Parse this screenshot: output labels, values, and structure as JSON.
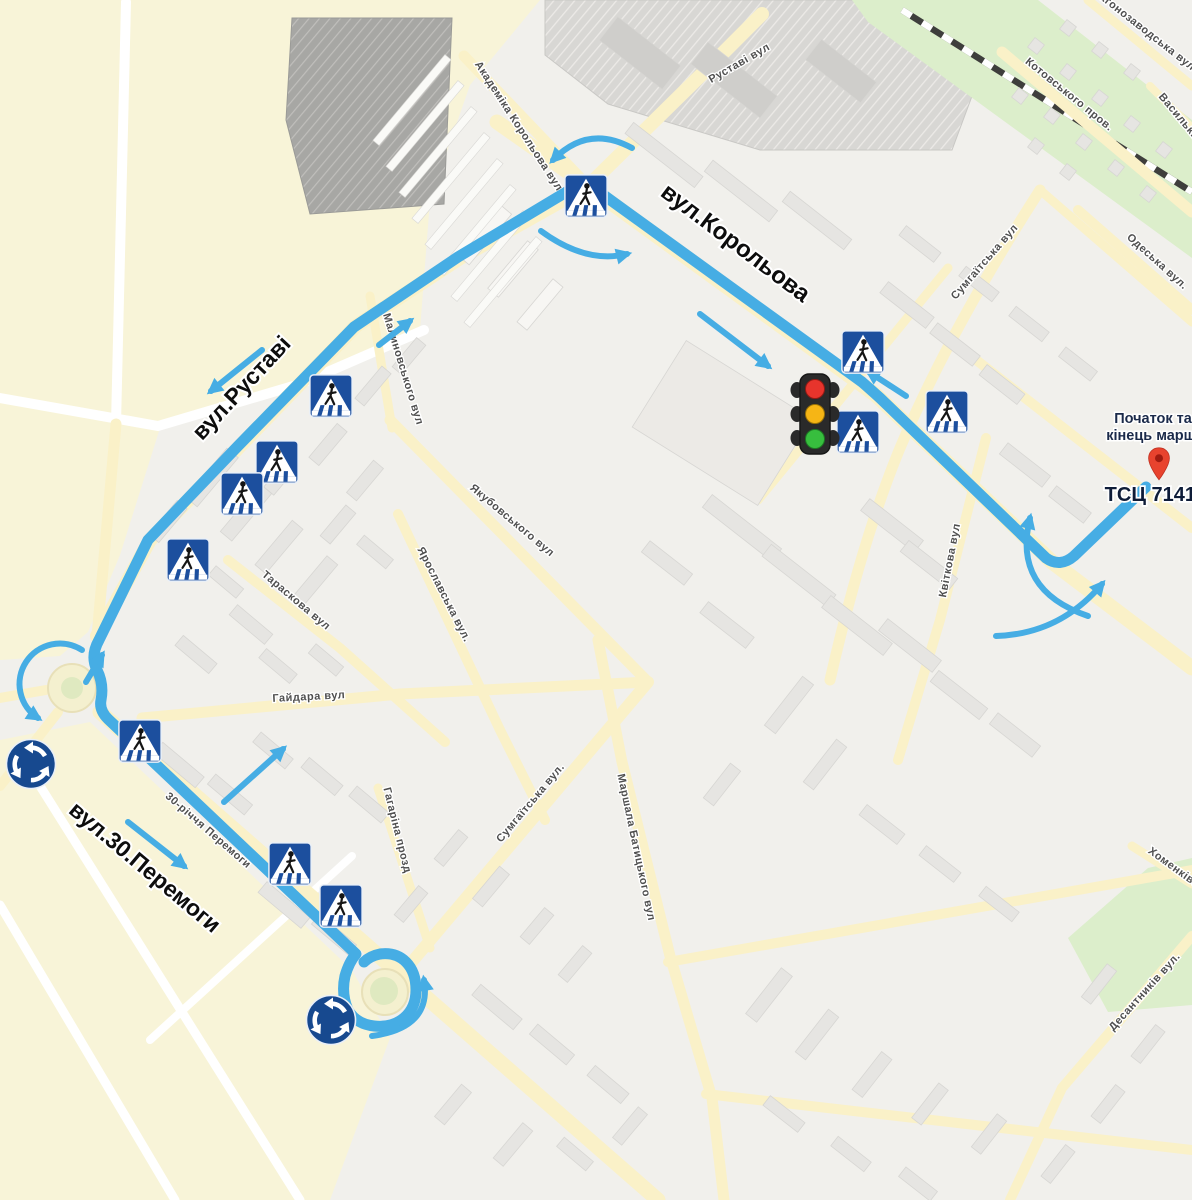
{
  "route_labels": [
    {
      "name": "route-street-label-korolova",
      "text": "вул.Корольова",
      "x": 731,
      "y": 249,
      "rot": 37,
      "size": 24
    },
    {
      "name": "route-street-label-rustavi",
      "text": "вул.Руставі",
      "x": 247,
      "y": 393,
      "rot": -47,
      "size": 23
    },
    {
      "name": "route-street-label-peremohy",
      "text": "вул.30.Перемоги",
      "x": 140,
      "y": 873,
      "rot": 40,
      "size": 23
    }
  ],
  "street_labels": [
    {
      "text": "Руставі вул",
      "x": 741,
      "y": 66,
      "rot": -30
    },
    {
      "text": "Академіка Корольова вул",
      "x": 516,
      "y": 128,
      "rot": 57
    },
    {
      "text": "Котовського пров.",
      "x": 1067,
      "y": 97,
      "rot": 39
    },
    {
      "text": "Вагонозаводська вул",
      "x": 1142,
      "y": 32,
      "rot": 38
    },
    {
      "text": "Васильківська",
      "x": 1186,
      "y": 130,
      "rot": 50
    },
    {
      "text": "Одеська вул.",
      "x": 1155,
      "y": 264,
      "rot": 42
    },
    {
      "text": "Сумгаїтська вул",
      "x": 987,
      "y": 264,
      "rot": -49
    },
    {
      "text": "Квіткова вул",
      "x": 953,
      "y": 561,
      "rot": -79
    },
    {
      "text": "Малиновського вул",
      "x": 400,
      "y": 370,
      "rot": 73
    },
    {
      "text": "Якубовського вул",
      "x": 510,
      "y": 523,
      "rot": 40
    },
    {
      "text": "Ярославська вул.",
      "x": 441,
      "y": 596,
      "rot": 63
    },
    {
      "text": "Тараскова вул",
      "x": 294,
      "y": 603,
      "rot": 40
    },
    {
      "text": "Гайдара вул",
      "x": 309,
      "y": 700,
      "rot": -3
    },
    {
      "text": "Сумгаїтська вул.",
      "x": 533,
      "y": 805,
      "rot": -50
    },
    {
      "text": "Маршала Батицького вул",
      "x": 633,
      "y": 848,
      "rot": 78
    },
    {
      "text": "Гагаріна прозд",
      "x": 394,
      "y": 831,
      "rot": 76
    },
    {
      "text": "30-річчя Перемоги",
      "x": 206,
      "y": 833,
      "rot": 41
    },
    {
      "text": "Десантників вул.",
      "x": 1147,
      "y": 994,
      "rot": -48
    },
    {
      "text": "Хоменківська",
      "x": 1180,
      "y": 876,
      "rot": 36
    }
  ],
  "endpoint": {
    "line1": "Початок та",
    "line2": "кінець маршрут",
    "poi": "ТСЦ 7141",
    "pin": [
      1159,
      464
    ]
  },
  "signs": {
    "crosswalks": [
      [
        586,
        196
      ],
      [
        331,
        396
      ],
      [
        277,
        462
      ],
      [
        242,
        494
      ],
      [
        188,
        560
      ],
      [
        863,
        352
      ],
      [
        858,
        432
      ],
      [
        947,
        412
      ],
      [
        140,
        741
      ],
      [
        290,
        864
      ],
      [
        341,
        906
      ]
    ],
    "roundabouts": [
      [
        31,
        764
      ],
      [
        331,
        1020
      ]
    ],
    "traffic_light": [
      815,
      414
    ]
  },
  "icons": {
    "crosswalk_sign": "pedestrian-crossing-sign",
    "roundabout_sign": "roundabout-sign",
    "traffic_light": "traffic-light",
    "endpoint_pin": "map-pin"
  },
  "colors": {
    "route": "#46ADE4",
    "sign_blue": "#1C4F9E",
    "road_yellow": "#FAF1C8",
    "map_base": "#F1F0EC",
    "rail_green": "#DCEECB",
    "pin_red": "#E8432E"
  }
}
